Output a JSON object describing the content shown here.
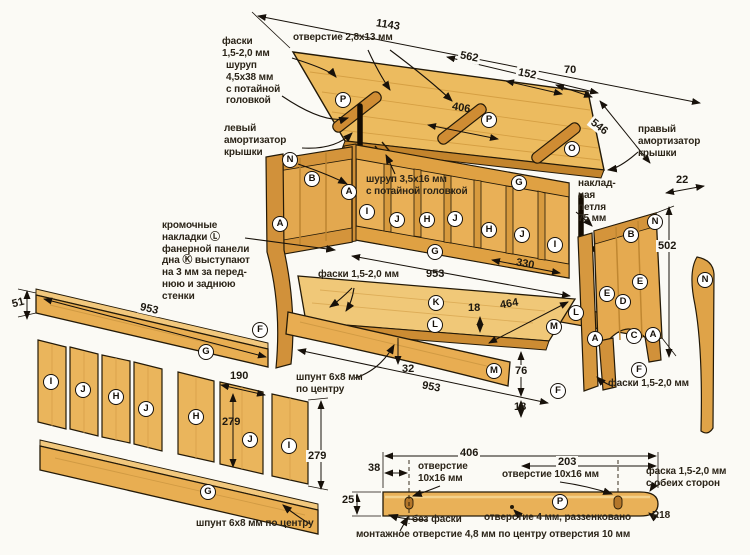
{
  "colors": {
    "wood": "#e9b257",
    "wood_light": "#f2ca7c",
    "wood_dark": "#c9882f",
    "outline": "#241a08",
    "background": "#fbfaf5"
  },
  "labels": {
    "chamfer_top": "фаски\n1,5-2,0 мм",
    "hole_2_8x13": "отверстие 2,8х13 мм",
    "screw_4_5x38": "шуруп\n4,5х38 мм\nс потайной\nголовкой",
    "left_damper": "левый\nамортизатор\nкрышки",
    "right_damper": "правый\nамортизатор\nкрышки",
    "screw_3_5x16": "шуруп 3,5х16 мм\nс потайной головкой",
    "overlay_hinge": "наклад-\nная\nпетля\n75 мм",
    "edge_trims": "кромочные\nнакладки Ⓛ\nфанерной панели\nдна Ⓚ выступают\nна 3 мм за перед-\nнюю и заднюю\nстенки",
    "chamfer_center": "фаски 1,5-2,0 мм",
    "tongue_mid": "шпунт 6х8 мм\nпо центру",
    "chamfer_right": "фаски 1,5-2,0 мм",
    "tongue_bottom": "шпунт 6х8 мм по центру",
    "hole_left": "отверстие\n10х16 мм",
    "hole_right": "отверстие 10х16 мм",
    "chamfer_both": "фаска 1,5-2,0 мм\nс обеих сторон",
    "no_chamfer": "без фаски",
    "hole_4": "отверстие 4 мм, раззенковано",
    "radius_r18": "R18",
    "mounting_hole": "монтажное отверстие 4,8 мм по центру отверстия 10 мм"
  },
  "dims": {
    "lid_length": "1143",
    "lid_562": "562",
    "lid_152": "152",
    "lid_70": "70",
    "lid_406": "406",
    "lid_546": "546",
    "hinge_22": "22",
    "side_502": "502",
    "back_953": "953",
    "back_330": "330",
    "rail_51": "51",
    "rail_953": "953",
    "panel_190": "190",
    "panel_279_a": "279",
    "panel_279_b": "279",
    "bottom_18": "18",
    "bottom_464": "464",
    "front_32": "32",
    "front_953": "953",
    "front_76": "76",
    "front_18": "18",
    "det_406": "406",
    "det_38": "38",
    "det_203": "203",
    "det_25": "25"
  },
  "markers": [
    "P",
    "P",
    "O",
    "G",
    "I",
    "J",
    "H",
    "J",
    "H",
    "J",
    "I",
    "G",
    "N",
    "B",
    "A",
    "A",
    "F",
    "K",
    "L",
    "L",
    "M",
    "M",
    "F",
    "N",
    "B",
    "E",
    "E",
    "D",
    "A",
    "C",
    "A",
    "F",
    "N",
    "G",
    "I",
    "J",
    "H",
    "J",
    "H",
    "J",
    "I",
    "G",
    "P"
  ]
}
